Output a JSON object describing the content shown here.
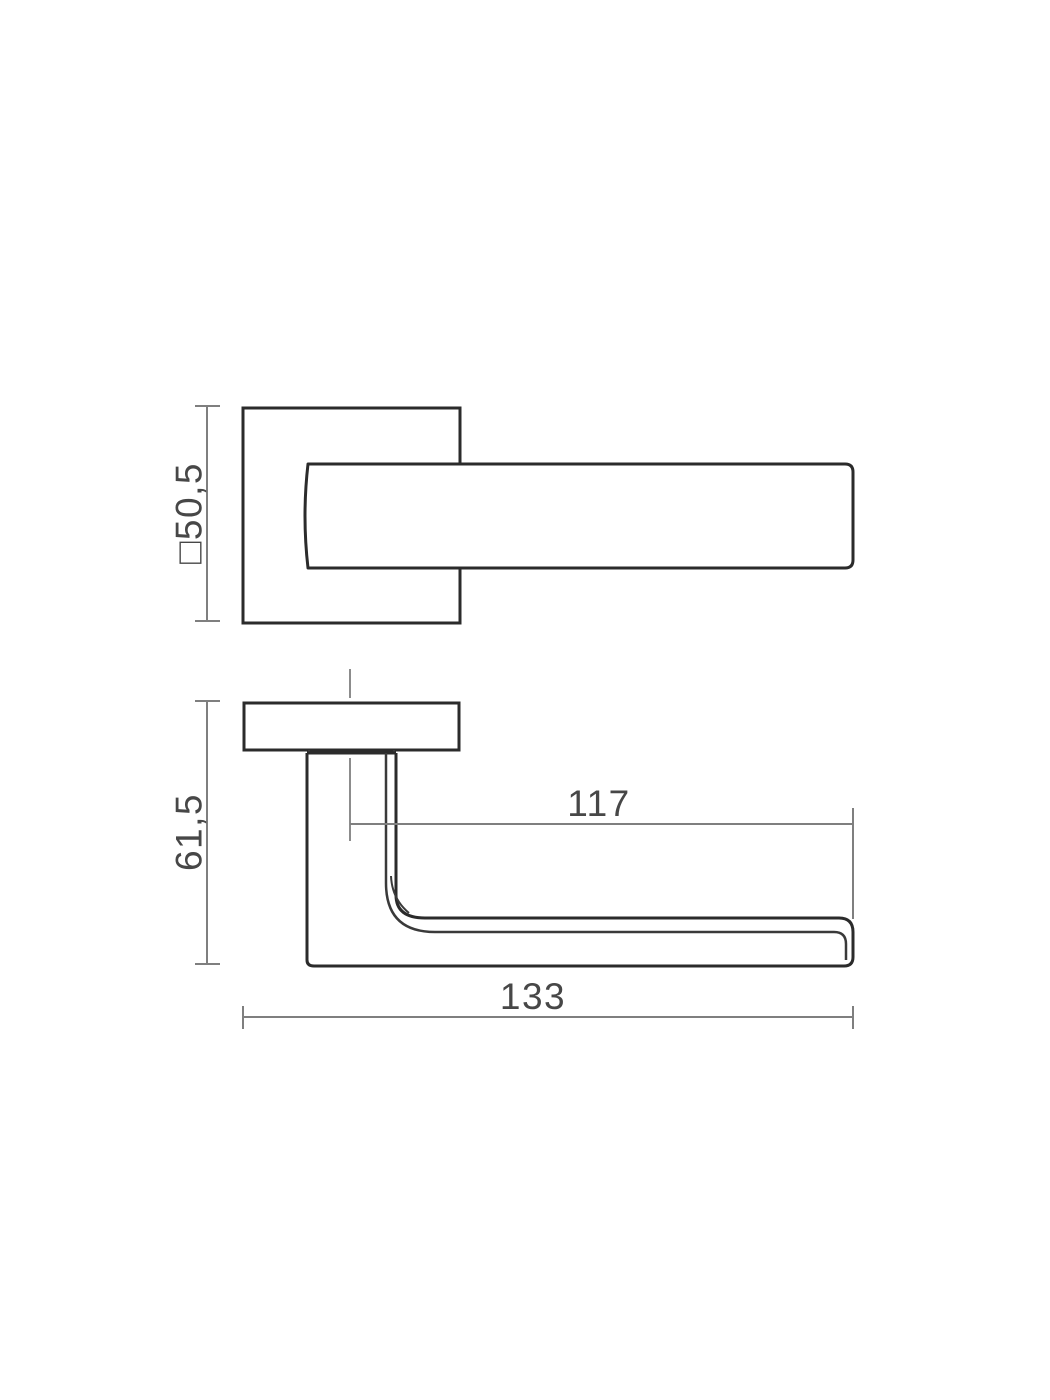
{
  "drawing": {
    "description": "Technical dimensional drawing of a door lever handle on a square rose, front view and side view",
    "colors": {
      "background": "#ffffff",
      "outline": "#2b2b2b",
      "secondary_edge": "#3a3a3a",
      "dimension_line": "#7f7f7f",
      "centerline": "#8c8c8c",
      "label_text": "#474747"
    },
    "front_view": {
      "rose_size_label": "□50,5"
    },
    "side_view": {
      "height_label": "61,5",
      "grip_length_label": "117",
      "overall_length_label": "133"
    }
  }
}
